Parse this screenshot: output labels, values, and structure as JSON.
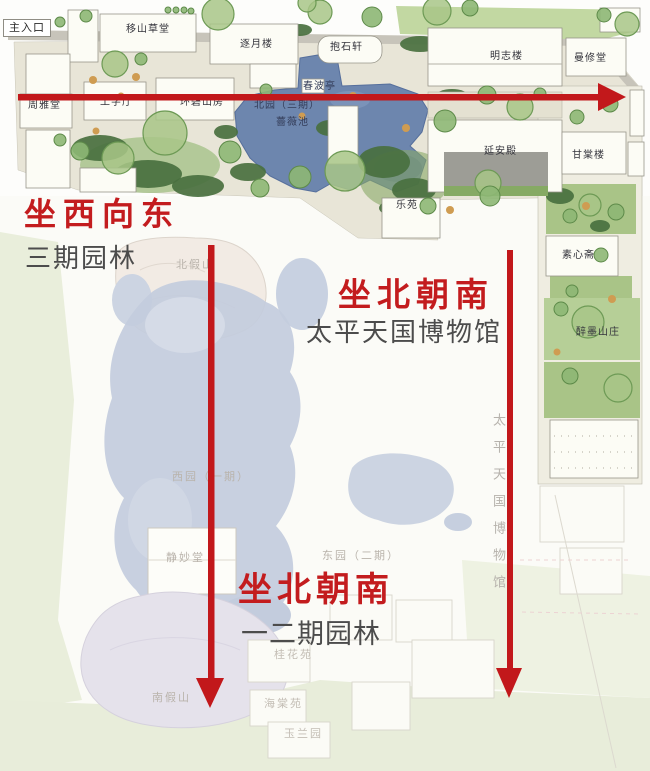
{
  "annotations": {
    "west_to_east": {
      "title": "坐西向东",
      "subtitle": "三期园林"
    },
    "museum": {
      "title": "坐北朝南",
      "subtitle": "太平天国博物馆"
    },
    "garden12": {
      "title": "坐北朝南",
      "subtitle": "一二期园林"
    }
  },
  "map": {
    "entrance": "主入口",
    "vertical_side_label": "太平天国博物馆",
    "labels": [
      "移山草堂",
      "逐月楼",
      "抱石轩",
      "明志楼",
      "曼修堂",
      "周雅堂",
      "工字厅",
      "环碧山房",
      "春波亭",
      "北园（三期）",
      "薔薇池",
      "延安殿",
      "甘棠楼",
      "乐苑",
      "素心斋",
      "醉墨山庄",
      "北假山",
      "西园（一期）",
      "静妙堂",
      "东园（二期）",
      "桂花苑",
      "南假山",
      "海棠苑",
      "玉兰园"
    ]
  },
  "colors": {
    "arrow_red": "#c2181b",
    "annotation_red": "#c31c1e",
    "annotation_gray": "#4c4c4c",
    "pond_blue": "#6d86ae",
    "faint_pond_blue": "#c3ccdd",
    "tree_green": "#a8c687"
  }
}
